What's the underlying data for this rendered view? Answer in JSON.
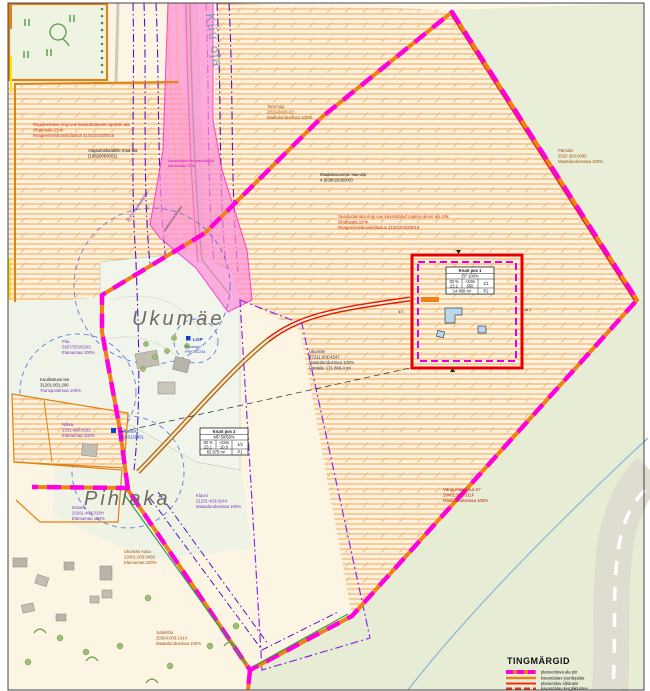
{
  "map": {
    "stream_label": "Küü oja",
    "area_labels": {
      "ukumae": "Ukumäe",
      "pihlaka": "Pihlaka"
    },
    "notes": {
      "red_note_top": [
        "Reguleeritava ringi uue kavandatavate rajatiste ala",
        "Ohutusala 23 m",
        "Reageerimiskooskõlastus 4105/2020/0018"
      ],
      "substation_note": [
        "Alajaamakaablite maa-ala",
        "(19820063001)"
      ],
      "land_note": [
        "Maakasutuseta maa-ala",
        "4 (63802630000)"
      ],
      "red_note_mid": [
        "Seadustamata ringi uue kavandatud rajatise alune ala 10k",
        "Ohutusala 10 m",
        "Reageerimiskooskõlastus 4105/2020/0018"
      ],
      "corridor_label_1": "10 kV maakaabelliin",
      "corridor_label_2": "sademeveekraav",
      "flare_label_1": "kavandatava tee maa-ala piir",
      "flare_label_2": "laiendusala 12 m"
    },
    "parcels": {
      "tammoja": [
        "Tammoja",
        "2819-0420-02",
        "Maatulundusmaa 100%"
      ],
      "parnala": [
        "Pärnala",
        "2520 303:0085",
        "Maatulundusmaa 100%"
      ],
      "pia": [
        "Piia",
        "0957/333/0203",
        "Elamumaa 100%"
      ],
      "kuullastuse": [
        "Kuullastuse tee",
        "31201:001:206",
        "Transpordimaa 100%"
      ],
      "nolva": [
        "Nõlva",
        "2331:403:0181",
        "Elamumaa 100%"
      ],
      "dotura": [
        "Dotura",
        "20291:403:018H",
        "Elamumaa 100%"
      ],
      "klaus": [
        "Klausi",
        "21201:403:0244",
        "Maatulundusmaa 100%"
      ],
      "ukumae_aasa": [
        "Ukumäe Aasa",
        "29301:003:0456",
        "Elamumaa 100%"
      ],
      "jutilehtla": [
        "Jutilehtla",
        "29304:003:1414",
        "Maatulundusmaa 100%"
      ],
      "ukumae_parcel": [
        "Ukumäe",
        "97311:001:4547",
        "Maatulundusmaa 100%",
        "Pindala: 171 860,4 m²"
      ],
      "vanga": [
        "Vängi maaüksus 57",
        "29401:303:031F",
        "Maatulundusmaa 100%"
      ]
    },
    "markers": {
      "lop": "LOP",
      "lop_sub": [
        "Puurkaev",
        "PRK001234"
      ],
      "puurk": [
        "PUURK#1",
        "PRK0131451"
      ]
    },
    "tables": {
      "krunt1": {
        "title": "Krunt pos 1",
        "subtitle": "EP 100%",
        "c1a": "30 %",
        "c1b": "23,1",
        "c2a": "+23m",
        "c2b": "550",
        "c3": "1/1",
        "area": "14 800 m²",
        "code": "P2"
      },
      "krunt2": {
        "title": "Krunt pos 2",
        "subtitle": "MP 50/50%",
        "c1a": "30 %",
        "c1b": "23,1",
        "c2a": "+23m",
        "c2b": "10,0",
        "c3": "1/2",
        "area": "63 875 m²",
        "code": "P1"
      }
    },
    "measurements": {
      "m1": "4,0",
      "m2": "44,1"
    },
    "legend": {
      "title": "TINGMÄRGID",
      "items": [
        {
          "label": "planeeritava ala piir"
        },
        {
          "label": "kavandatav juurdepääs"
        },
        {
          "label": "planeeritav sõidutee"
        },
        {
          "label": "kavandatav kergliiklustee"
        }
      ]
    },
    "colors": {
      "boundary": "#ff00dd",
      "road_orange": "#f08018",
      "road_red": "#e02000",
      "utility_purple": "#5b10c8",
      "water_blue": "#8ab4d8"
    }
  }
}
